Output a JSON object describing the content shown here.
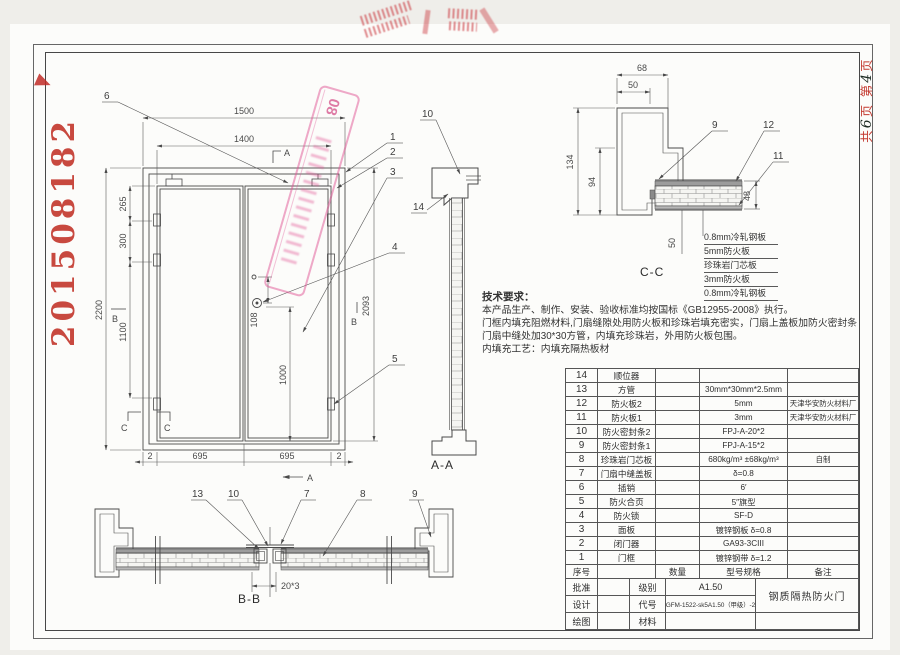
{
  "sheet": {
    "serial_number": "201508182",
    "page_note": {
      "p1": "共",
      "n1": "6",
      "p2": "页",
      "p3": "第",
      "n2": "4",
      "p4": "页"
    },
    "diagonal_stamp_text": "08"
  },
  "elevation": {
    "dims": {
      "w_outer": "1500",
      "w_inner": "1400",
      "h_left": "2200",
      "left_a": "265",
      "left_b": "300",
      "left_c": "1100",
      "right_a": "108",
      "right_b": "1000",
      "right_c": "2093",
      "bot_1": "2",
      "bot_2": "695",
      "bot_3": "695",
      "bot_4": "2"
    },
    "marks": {
      "a": "A",
      "b": "B",
      "c": "C"
    },
    "leaders": {
      "l1": "1",
      "l2": "2",
      "l3": "3",
      "l4": "4",
      "l5": "5",
      "l6": "6"
    }
  },
  "section_aa": {
    "label": "A-A",
    "leader_10": "10",
    "leader_14": "14"
  },
  "section_cc": {
    "label": "C-C",
    "dims": {
      "d68": "68",
      "d50": "50",
      "d134": "134",
      "d94": "94",
      "d48": "48",
      "d50b": "50"
    },
    "leaders": {
      "l9": "9",
      "l11": "11",
      "l12": "12"
    },
    "layers": [
      "0.8mm冷轧钢板",
      "5mm防火板",
      "珍珠岩门芯板",
      "3mm防火板",
      "0.8mm冷轧钢板"
    ]
  },
  "section_bb": {
    "label": "B-B",
    "dim": "20*3",
    "leaders": {
      "l13": "13",
      "l10": "10",
      "l7": "7",
      "l8": "8",
      "l9": "9"
    }
  },
  "notes": {
    "title": "技术要求：",
    "lines": [
      "本产品生产、制作、安装、验收标准均按国标《GB12955-2008》执行。",
      "门框内填充阻燃材料,门扇缝隙处用防火板和珍珠岩填充密实，门扇上盖板加防火密封条",
      "门扇中缝处加30*30方管，内填充珍珠岩，外用防火板包围。",
      "内填充工艺：内填充隔热板材"
    ]
  },
  "parts_table": {
    "header": {
      "no": "序号",
      "name": "",
      "qty": "数量",
      "spec": "型号规格",
      "remark": "备注"
    },
    "rows": [
      {
        "no": "14",
        "name": "顺位器",
        "qty": "",
        "spec": "",
        "remark": ""
      },
      {
        "no": "13",
        "name": "方管",
        "qty": "",
        "spec": "30mm*30mm*2.5mm",
        "remark": ""
      },
      {
        "no": "12",
        "name": "防火板2",
        "qty": "",
        "spec": "5mm",
        "remark": "天津华安防火材料厂"
      },
      {
        "no": "11",
        "name": "防火板1",
        "qty": "",
        "spec": "3mm",
        "remark": "天津华安防火材料厂"
      },
      {
        "no": "10",
        "name": "防火密封条2",
        "qty": "",
        "spec": "FPJ-A-20*2",
        "remark": ""
      },
      {
        "no": "9",
        "name": "防火密封条1",
        "qty": "",
        "spec": "FPJ-A-15*2",
        "remark": ""
      },
      {
        "no": "8",
        "name": "珍珠岩门芯板",
        "qty": "",
        "spec": "680kg/m³ ±68kg/m³",
        "remark": "自制"
      },
      {
        "no": "7",
        "name": "门扇中缝盖板",
        "qty": "",
        "spec": "δ=0.8",
        "remark": ""
      },
      {
        "no": "6",
        "name": "插销",
        "qty": "",
        "spec": "6′",
        "remark": ""
      },
      {
        "no": "5",
        "name": "防火合页",
        "qty": "",
        "spec": "5″旗型",
        "remark": ""
      },
      {
        "no": "4",
        "name": "防火锁",
        "qty": "",
        "spec": "SF-D",
        "remark": ""
      },
      {
        "no": "3",
        "name": "面板",
        "qty": "",
        "spec": "镀锌钢板 δ=0.8",
        "remark": ""
      },
      {
        "no": "2",
        "name": "闭门器",
        "qty": "",
        "spec": "GA93-3CIII",
        "remark": ""
      },
      {
        "no": "1",
        "name": "门框",
        "qty": "",
        "spec": "镀锌钢带  δ=1.2",
        "remark": ""
      }
    ]
  },
  "title_block": {
    "approve": "批准",
    "design": "设计",
    "draw": "绘图",
    "grade_label": "级别",
    "grade": "A1.50",
    "code_label": "代号",
    "code": "GFM-1522-sk5A1.50（甲级）-2",
    "material_label": "材料",
    "product": "钢质隔热防火门"
  }
}
